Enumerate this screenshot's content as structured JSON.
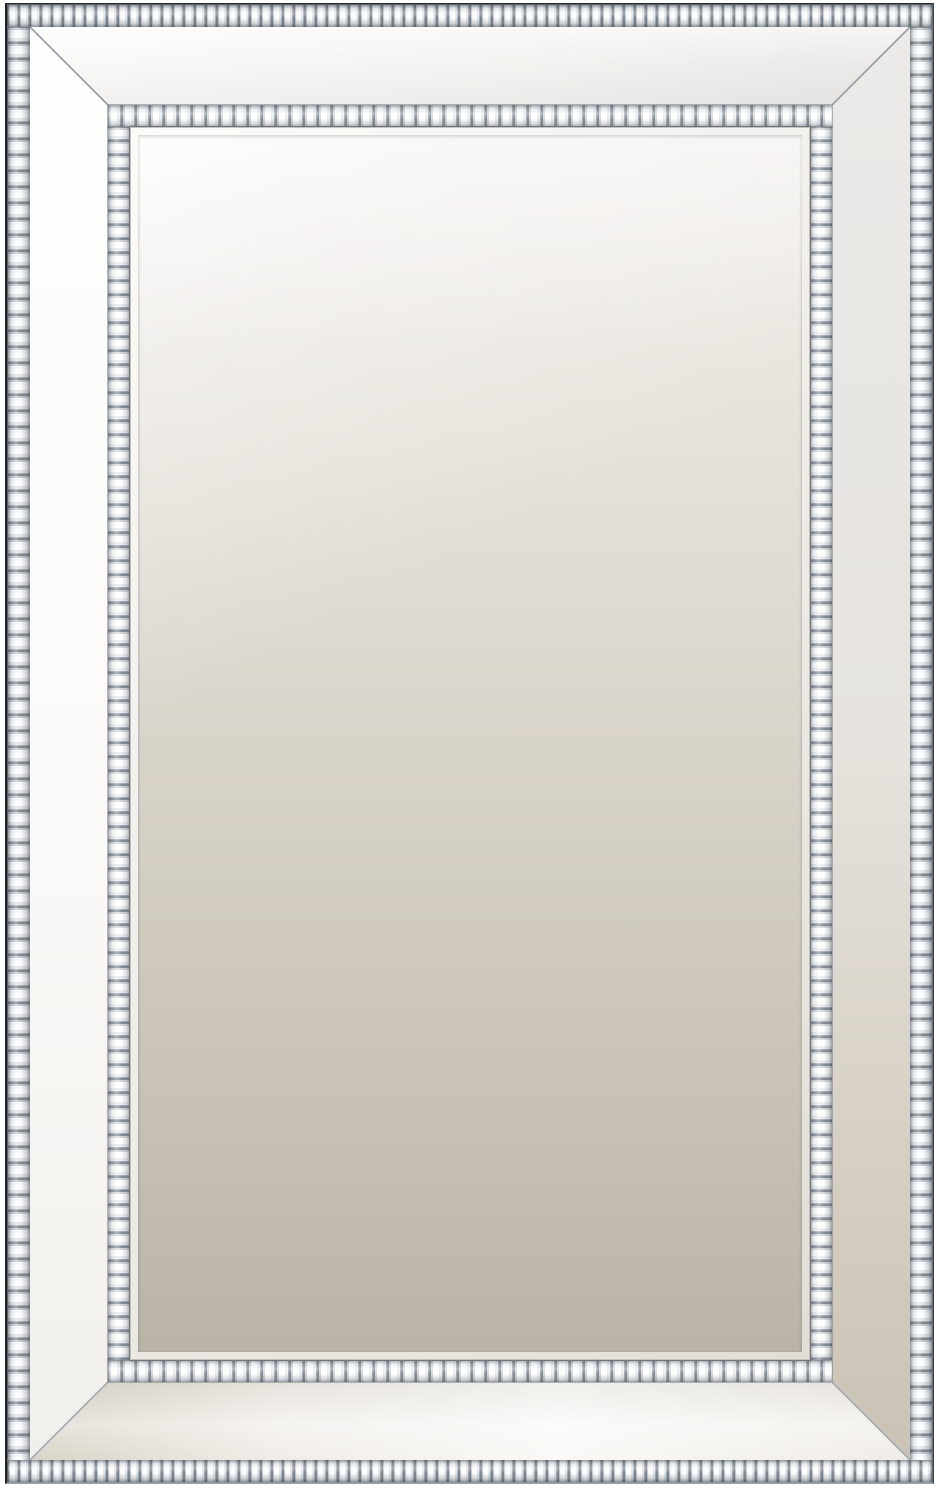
{
  "scene": {
    "type": "product-photo",
    "subject": "Rectangular silver wall mirror with a wide beveled mirror frame, crystal beaded trim on the inner and outer edges, photographed on a white background",
    "background_color": "#ffffff"
  },
  "frame": {
    "outer_edge_color": "#262b33",
    "bead_bright_color": "#ffffff",
    "bead_mid_color": "#d6dbdf",
    "bead_shadow_color": "#7f868e",
    "panel_top_color": "#f5f3f0",
    "panel_left_color": "#fbfaf8",
    "panel_right_color": "#d4cdc0",
    "panel_bottom_color": "#f0ede8",
    "miter_line_color": "#9ba1a7",
    "bevel_highlight_color": "#fbfbf9",
    "bevel_edge_color": "#6f757d"
  },
  "glass": {
    "top_color": "#f0ede9",
    "middle_color": "#d8d3c9",
    "bottom_color": "#b9b4a6",
    "highlight_color": "rgba(255,255,255,0.78)"
  }
}
